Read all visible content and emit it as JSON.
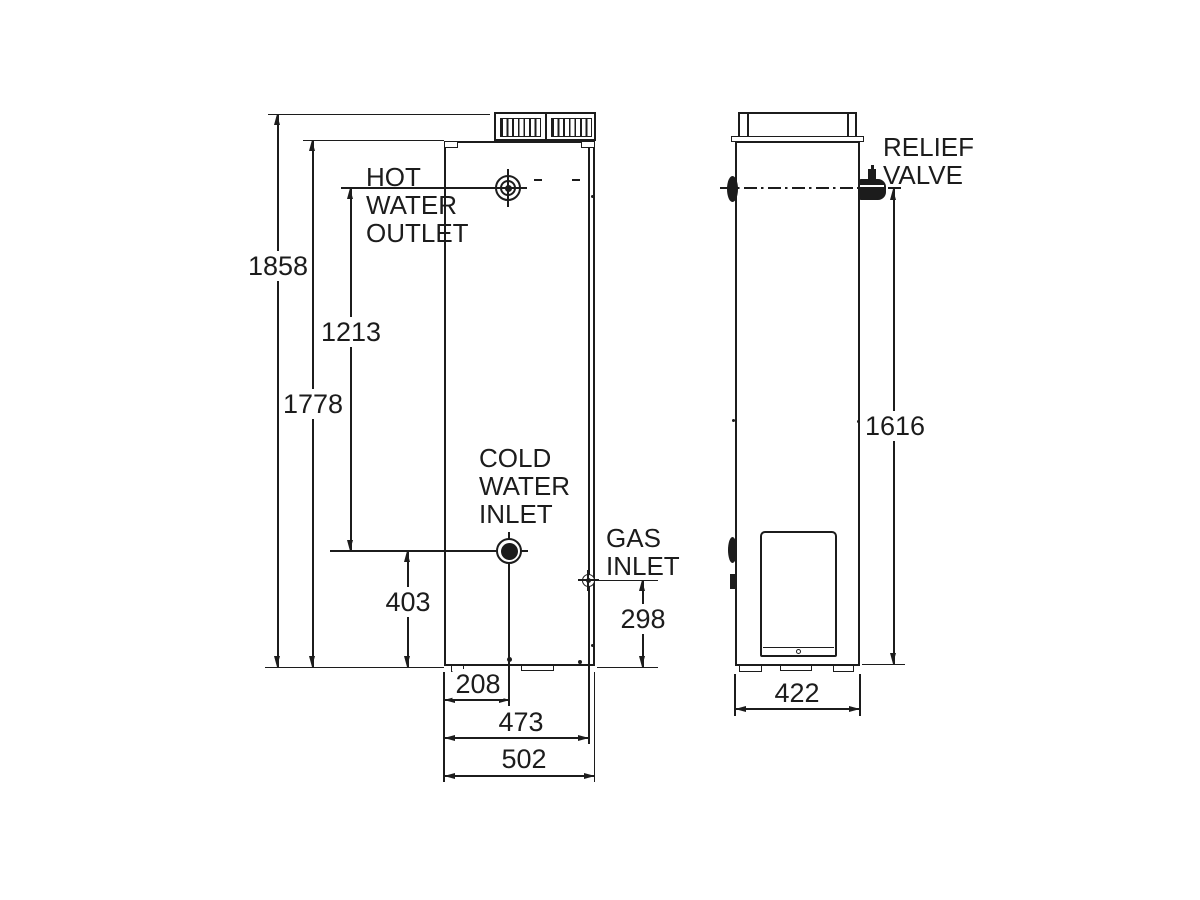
{
  "dimensions": {
    "overall_height": "1858",
    "jacket_height": "1778",
    "outlet_to_inlet": "1213",
    "cold_inlet_height": "403",
    "cold_inlet_offset": "208",
    "gas_inlet_offset": "473",
    "overall_depth": "502",
    "gas_inlet_height": "298",
    "relief_valve_height": "1616",
    "overall_width": "422"
  },
  "labels": {
    "hot_water_outlet": [
      "HOT",
      "WATER",
      "OUTLET"
    ],
    "cold_water_inlet": [
      "COLD",
      "WATER",
      "INLET"
    ],
    "gas_inlet": [
      "GAS",
      "INLET"
    ],
    "relief_valve": [
      "RELIEF",
      "VALVE"
    ]
  },
  "colors": {
    "line": "#1c1c1c",
    "background": "#ffffff"
  }
}
